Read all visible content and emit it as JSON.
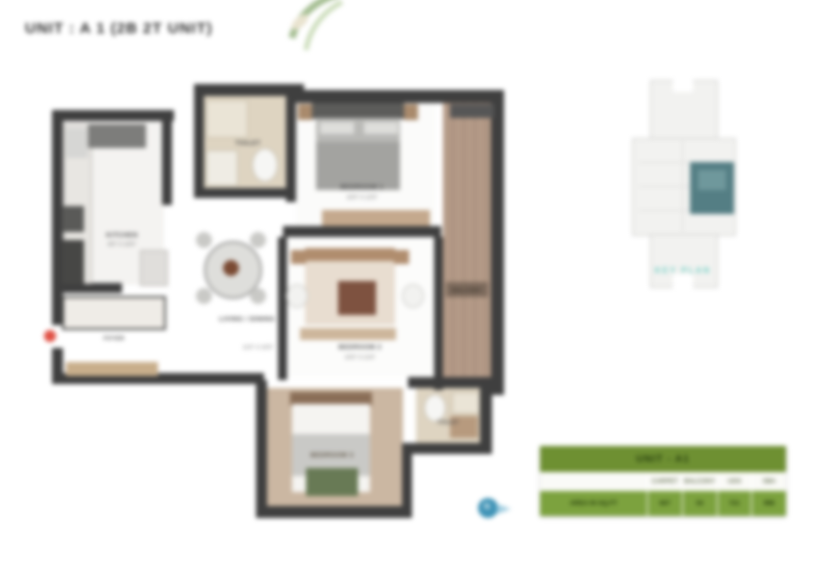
{
  "title": "UNIT : A 1 (2B 2T UNIT)",
  "key_plan": {
    "caption": "KEY PLAN"
  },
  "rooms": {
    "kitchen": {
      "label": "KITCHEN",
      "dims": "8'0\" X 10'0\""
    },
    "toilet1": {
      "label": "TOILET",
      "dims": "5'0\" X 8'0\""
    },
    "bedroom1": {
      "label": "BEDROOM 1",
      "dims": "10'0\" X 12'0\""
    },
    "balcony": {
      "label": "BALCONY",
      "dims": ""
    },
    "living_dining": {
      "label": "LIVING / DINING",
      "dims": "11'6\" X 16'0\""
    },
    "bedroom2": {
      "label": "BEDROOM 2",
      "dims": "10'0\" X 11'6\""
    },
    "bedroom3": {
      "label": "BEDROOM 3",
      "dims": "10'0\" X 11'0\""
    },
    "toilet2": {
      "label": "TOILET",
      "dims": "5'0\" X 8'0\""
    },
    "foyer": {
      "label": "FOYER",
      "dims": ""
    }
  },
  "area_table": {
    "header": "UNIT - A1",
    "row_label": "AREA IN SQ.FT",
    "columns": [
      "CARPET",
      "BALCONY",
      "UDS",
      "SBA"
    ],
    "values": [
      "667",
      "54",
      "721",
      "998"
    ]
  },
  "compass": {
    "label": "N"
  },
  "colors": {
    "wall": "#3f3f3f",
    "wood_floor": "#b09683",
    "tile_beige": "#ded4c1",
    "table_header_green": "#6e9032",
    "table_row_green": "#7ca23e",
    "keyplan_teal": "#547e84",
    "caption_teal": "#6ecfc4",
    "compass_blue": "#3f93b6",
    "entry_red": "#e05044"
  }
}
